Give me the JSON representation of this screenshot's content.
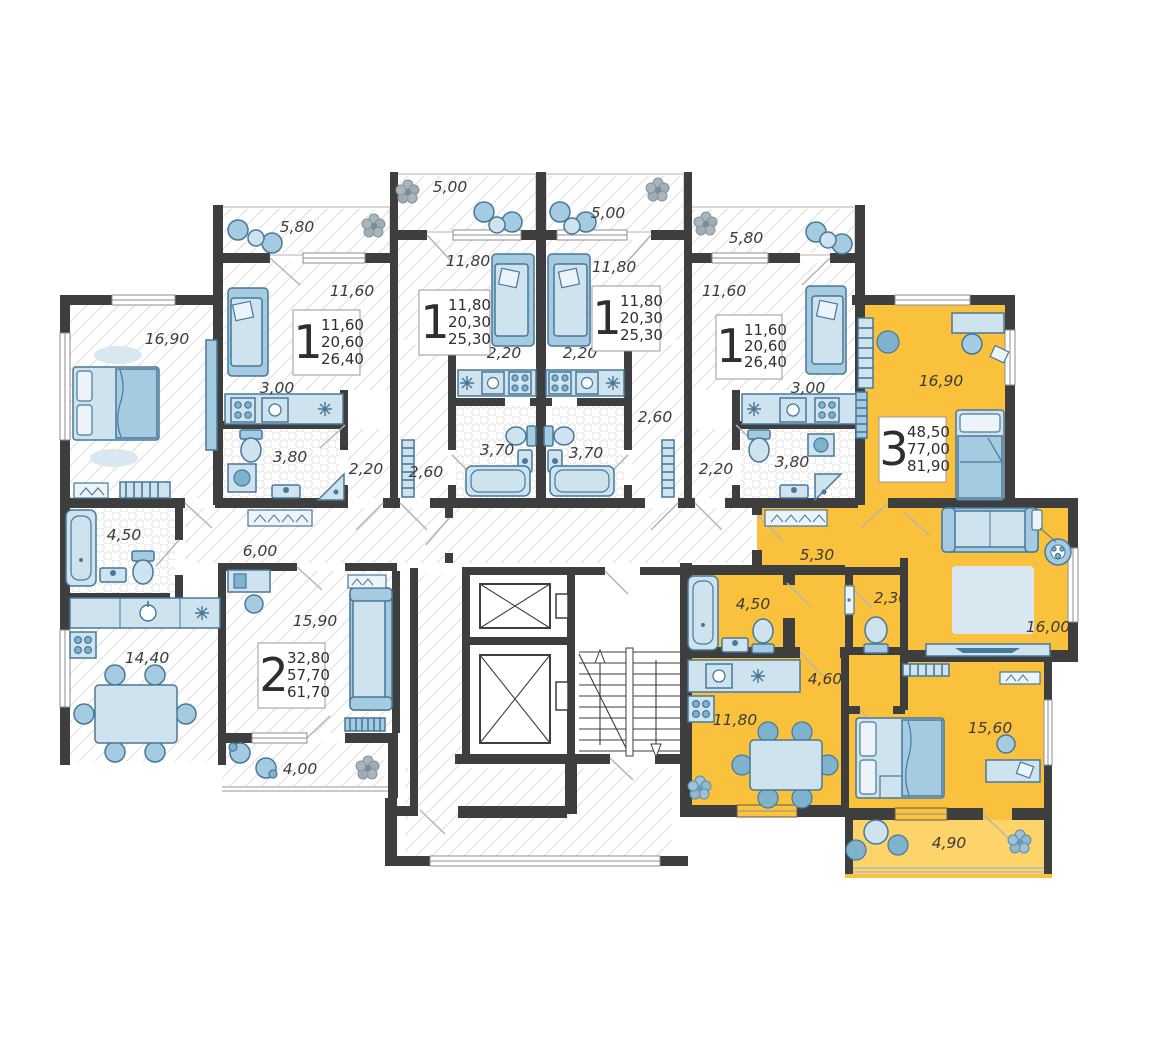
{
  "colors": {
    "highlight_apartment": "#FAC23C",
    "highlight_balcony": "#FCD469",
    "walls": "#3E3E3E",
    "furniture_fill": "#CFE3EF",
    "furniture_mid": "#A5CBE0",
    "furniture_stroke": "#47789A",
    "label_text": "#3B3B3B"
  },
  "apartments": {
    "one_a": {
      "type_label": "1",
      "area_living": "11,60",
      "area_no_balcony": "20,60",
      "area_total": "26,40"
    },
    "one_b": {
      "type_label": "1",
      "area_living": "11,80",
      "area_no_balcony": "20,30",
      "area_total": "25,30"
    },
    "one_c": {
      "type_label": "1",
      "area_living": "11,80",
      "area_no_balcony": "20,30",
      "area_total": "25,30"
    },
    "one_d": {
      "type_label": "1",
      "area_living": "11,60",
      "area_no_balcony": "20,60",
      "area_total": "26,40"
    },
    "two": {
      "type_label": "2",
      "area_living": "32,80",
      "area_no_balcony": "57,70",
      "area_total": "61,70"
    },
    "three": {
      "type_label": "3",
      "area_living": "48,50",
      "area_no_balcony": "77,00",
      "area_total": "81,90"
    }
  },
  "rooms": {
    "a_balcony": "5,80",
    "a_living": "11,60",
    "a_kitchen": "3,00",
    "a_bath": "3,80",
    "a_hall": "2,20",
    "b_balcony": "5,00",
    "b_living": "11,80",
    "b_kitchen": "2,20",
    "b_bath": "3,70",
    "b_hall": "2,60",
    "c_balcony": "5,00",
    "c_living": "11,80",
    "c_kitchen": "2,20",
    "c_bath": "3,70",
    "c_hall": "2,60",
    "d_balcony": "5,80",
    "d_living": "11,60",
    "d_kitchen": "3,00",
    "d_bath": "3,80",
    "d_hall": "2,20",
    "two_bedroom": "16,90",
    "two_bath": "4,50",
    "two_kitchen": "14,40",
    "two_hall": "6,00",
    "two_living": "15,90",
    "two_balcony": "4,00",
    "three_bedroom_1": "16,90",
    "three_hall_1": "5,30",
    "three_wc": "2,30",
    "three_living": "16,00",
    "three_bath": "4,50",
    "three_hall_2": "4,60",
    "three_kitchen": "11,80",
    "three_bedroom_2": "15,60",
    "three_balcony": "4,90"
  }
}
